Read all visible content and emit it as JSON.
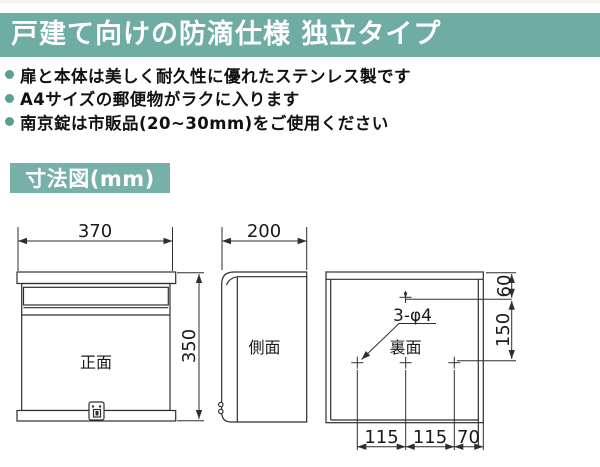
{
  "header": {
    "title": "戸建て向けの防滴仕様 独立タイプ"
  },
  "features": [
    {
      "text": "扉と本体は美しく耐久性に優れたステンレス製です"
    },
    {
      "text": "A4サイズの郵便物がラクに入ります"
    },
    {
      "text": "南京錠は市販品(20~30mm)をご使用ください"
    }
  ],
  "section": {
    "title": "寸法図(mm)"
  },
  "diagram": {
    "front": {
      "label": "正面",
      "width": "370",
      "height": "350"
    },
    "side": {
      "label": "側面",
      "depth": "200"
    },
    "back": {
      "label": "裏面",
      "holes_note": "3-φ4",
      "top_offset": "60",
      "vertical_pitch": "150",
      "bottom_pitches": [
        "115",
        "115",
        "70"
      ]
    }
  },
  "colors": {
    "header_bg": "#6FACA4",
    "badge_bg": "#76B0A8",
    "bullet": "#5C9D96",
    "line": "#2E2E2E"
  }
}
